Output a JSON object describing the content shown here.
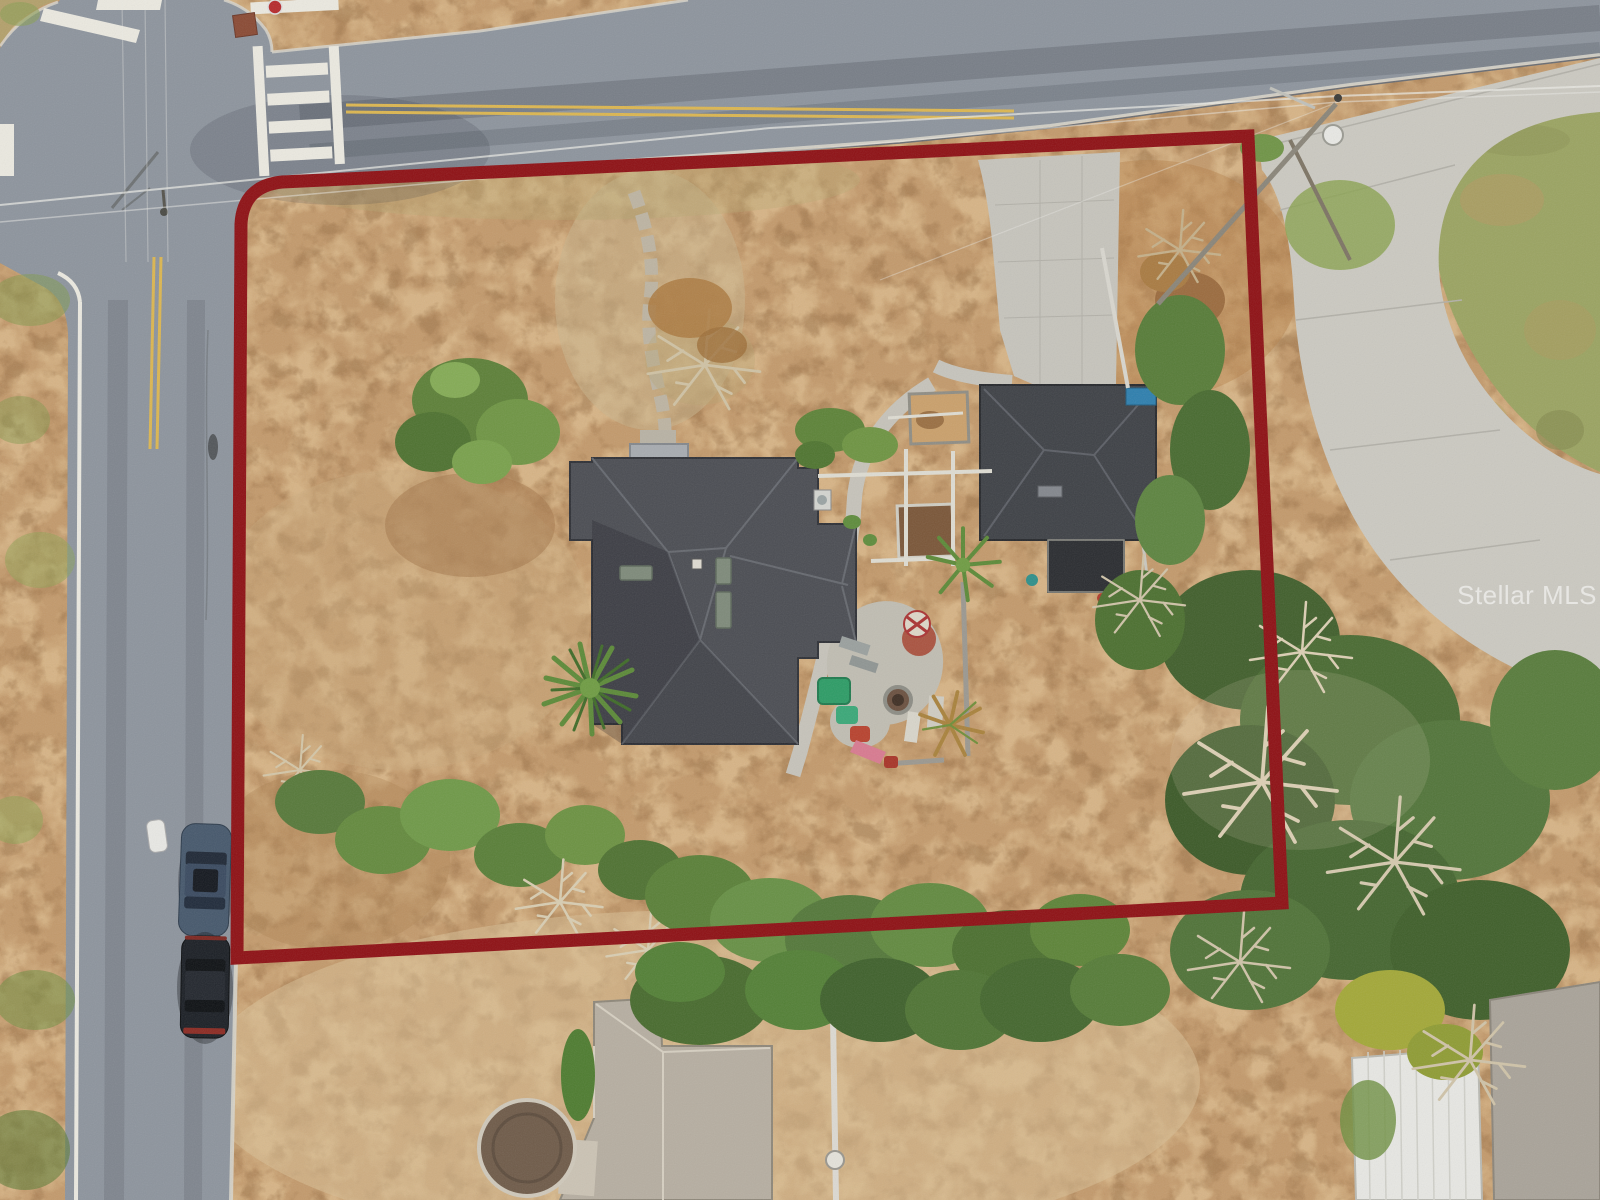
{
  "watermark": {
    "text": "Stellar MLS"
  },
  "colors": {
    "boundary": "#8e1014",
    "asphalt": "#8d949d",
    "dirt": "#c39a6c",
    "dirt_light": "#e2c394",
    "dirt_dark": "#996f45",
    "concrete": "#cbc9c1",
    "lawn": "#9ba462",
    "main_roof": "#4b4d53",
    "garage_roof": "#3e4146",
    "garage_flat_roof": "#2a2c30",
    "neighbor_roof": "#b6aea1",
    "shed_roof": "#e7e7e3",
    "corner_roof": "#a9a399",
    "marking_white": "#ebe9e0",
    "marking_yellow": "#dcb650",
    "tree_green": "#5d8038",
    "tree_dark": "#44652e",
    "tree_light": "#79a14c",
    "bare_branch": "#d8cdb2",
    "tarp_blue": "#2e7fae",
    "car_blue": "#46586c",
    "car_black": "#1b1f25",
    "fire_pit_brown": "#6b5140",
    "trampoline_brown": "#6f5b49",
    "watermark_fill": "rgba(255,255,255,0.55)"
  }
}
